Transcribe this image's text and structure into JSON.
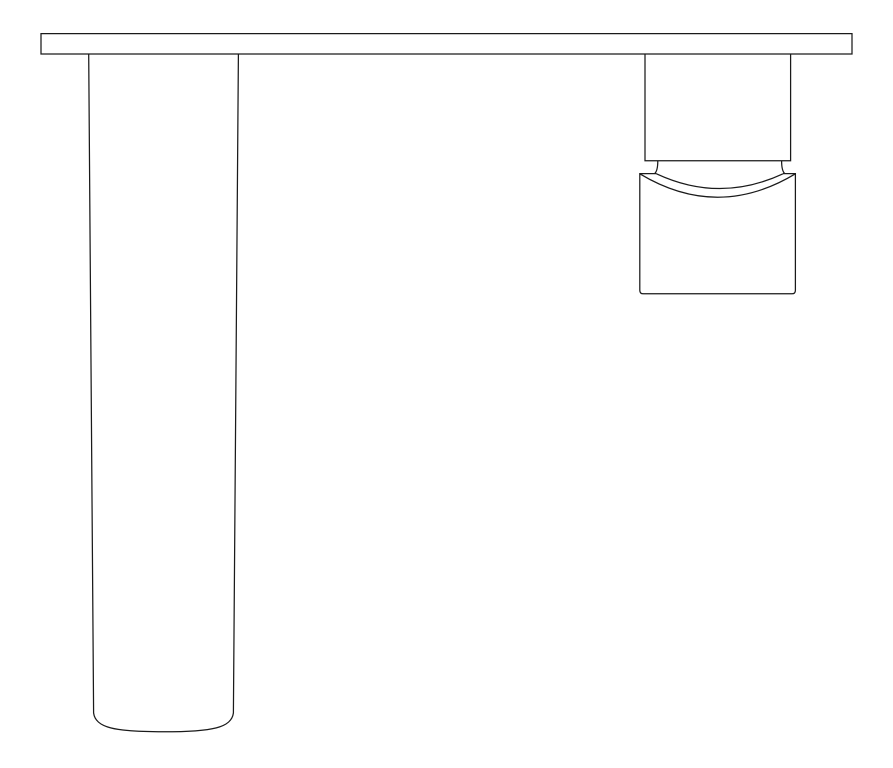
{
  "canvas": {
    "width": 893,
    "height": 768,
    "background": "#ffffff"
  },
  "style": {
    "stroke_color": "#1a1a1a",
    "stroke_width": 1.25
  },
  "drawing": {
    "label": "wall-mounted-tap-elevation-line-drawing",
    "shapes": [
      {
        "name": "wall-plate-outline",
        "kind": "path",
        "closed": true,
        "fill": "#ffffff",
        "d": "M 41,33.6 L 852,33.6 L 852,54 L 41,54 Z"
      },
      {
        "name": "spout-body-outline",
        "kind": "path",
        "closed": false,
        "fill": "none",
        "d": "M 88.7,54 L 93.6,713 C 95.5,727.5 114,731.8 163.5,731.8 C 213,731.8 231.5,727.5 233.4,713 L 238.4,54"
      },
      {
        "name": "handle-base-outline",
        "kind": "path",
        "closed": false,
        "fill": "none",
        "d": "M 645,54 L 645,160.7 L 790.6,160.7 L 790.6,54"
      },
      {
        "name": "handle-neck-left-line",
        "kind": "path",
        "closed": false,
        "fill": "none",
        "d": "M 657.8,160.7 C 657.8,166 657.2,171.5 654.5,173.6"
      },
      {
        "name": "handle-neck-right-line",
        "kind": "path",
        "closed": false,
        "fill": "none",
        "d": "M 781.6,160.7 C 781.6,166 782.2,171.5 784.9,173.6"
      },
      {
        "name": "handle-knob-outline",
        "kind": "path",
        "closed": false,
        "fill": "none",
        "d": "M 656.5,173.6 L 639.8,173.6 L 639.8,290.2 Q 639.8,293.8 643.3,293.8 L 791.9,293.8 Q 795.4,293.8 795.4,290.2 L 795.4,173.6 L 783,173.6"
      },
      {
        "name": "handle-knob-upper-arc",
        "kind": "path",
        "closed": false,
        "fill": "none",
        "d": "M 656.5,173.8 Q 719.7,203.3 783,173.8"
      },
      {
        "name": "handle-knob-lower-arc",
        "kind": "path",
        "closed": false,
        "fill": "none",
        "d": "M 639.8,173.8 Q 717.6,220.6 795.4,173.8"
      }
    ]
  }
}
